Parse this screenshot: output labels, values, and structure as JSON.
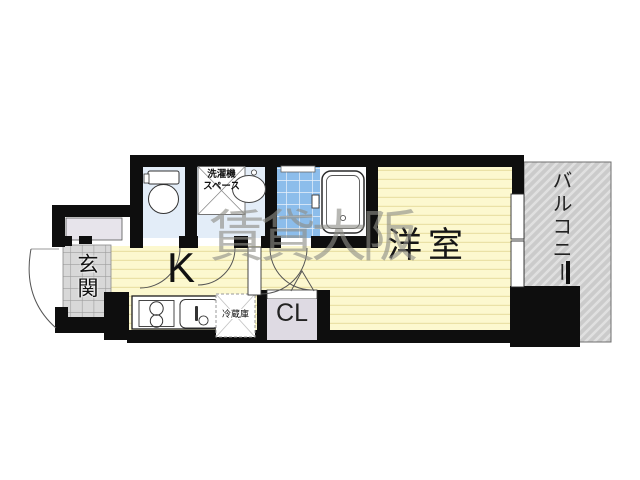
{
  "watermark": "賃貸大阪",
  "rooms": {
    "western_room": "洋室",
    "kitchen": "K",
    "entrance": "玄関",
    "balcony": "バルコニー",
    "closet": "CL",
    "washer_space": "洗濯機\nスペース",
    "refrigerator": "冷蔵庫"
  },
  "colors": {
    "wall": "#0e0e0e",
    "room_floor": "#fcf8cf",
    "room_floor_stripe": "#eae1a6",
    "sanitary_floor": "#e3edf8",
    "bath_tile": "#8cbdeb",
    "entrance_tile": "#d8d8d8",
    "balcony": "#cccccc",
    "closet_fill": "#dedae3",
    "pillar": "#e8dbc3",
    "watermark_color": "#8e8e87"
  }
}
